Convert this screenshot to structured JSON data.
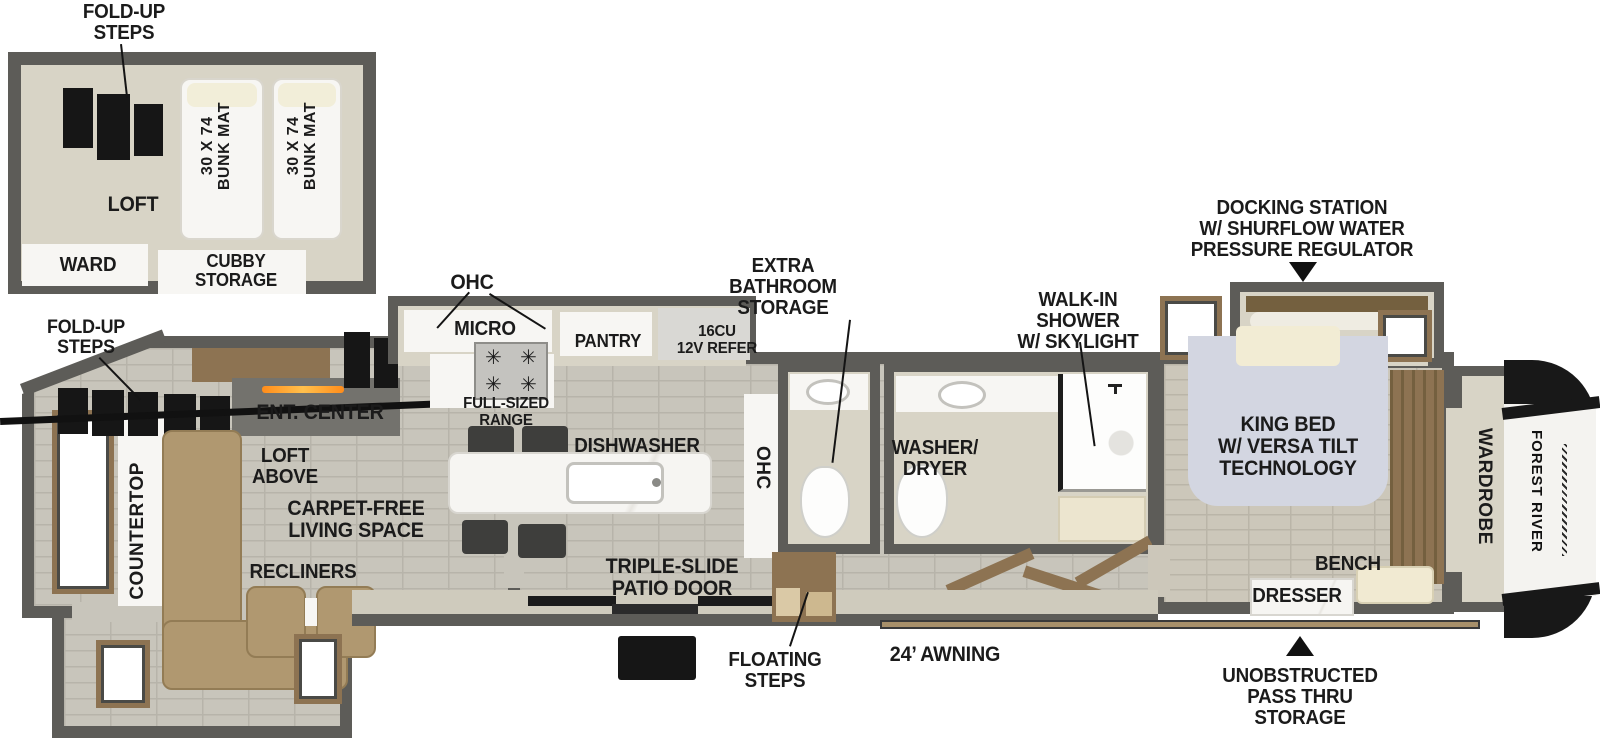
{
  "diagram_type": "RV fifth-wheel floor plan",
  "brand": "FOREST RIVER",
  "loft_inset": {
    "fold_up_steps": "FOLD-UP\nSTEPS",
    "loft": "LOFT",
    "ward": "WARD",
    "cubby_storage": "CUBBY\nSTORAGE",
    "bunk_mat_1": "30 X 74\nBUNK MAT",
    "bunk_mat_2": "30 X 74\nBUNK MAT"
  },
  "living": {
    "fold_up_steps": "FOLD-UP\nSTEPS",
    "ent_center": "ENT. CENTER",
    "loft_above": "LOFT\nABOVE",
    "carpet_free": "CARPET-FREE\nLIVING SPACE",
    "recliners": "RECLINERS",
    "countertop": "COUNTERTOP"
  },
  "kitchen": {
    "ohc_top": "OHC",
    "micro": "MICRO",
    "pantry": "PANTRY",
    "refer": "16CU\n12V REFER",
    "range": "FULL-SIZED\nRANGE",
    "dishwasher": "DISHWASHER",
    "ohc_side": "OHC"
  },
  "bathrooms": {
    "extra_storage": "EXTRA\nBATHROOM\nSTORAGE",
    "washer_dryer": "WASHER/\nDRYER",
    "walk_in_shower": "WALK-IN\nSHOWER\nW/ SKYLIGHT"
  },
  "bedroom": {
    "docking_station": "DOCKING STATION\nW/ SHURFLOW WATER\nPRESSURE REGULATOR",
    "king_bed": "KING BED\nW/ VERSA TILT\nTECHNOLOGY",
    "bench": "BENCH",
    "dresser": "DRESSER",
    "wardrobe": "WARDROBE"
  },
  "exterior": {
    "triple_slide_patio_door": "TRIPLE-SLIDE\nPATIO DOOR",
    "floating_steps": "FLOATING\nSTEPS",
    "awning": "24’ AWNING",
    "pass_thru": "UNOBSTRUCTED\nPASS THRU\nSTORAGE",
    "brand_logo": "FOREST RIVER"
  },
  "colors": {
    "wall": "#5d5c58",
    "floor_tile": "#c8c5bb",
    "interior_beige": "#d8d4c6",
    "wood": "#8d7352",
    "sofa_tan": "#b09870",
    "bed": "#d3d6e1",
    "fireplace_glow": "#ff8c1a",
    "label_text": "#1b1b1b"
  }
}
